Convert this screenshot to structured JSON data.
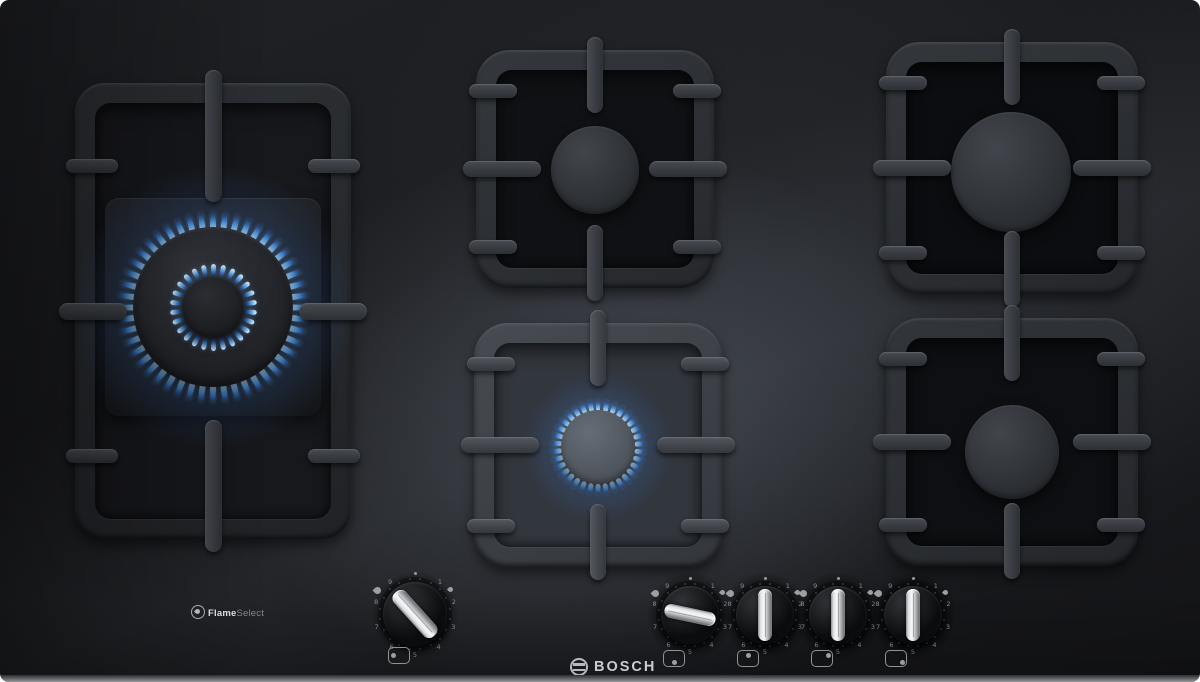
{
  "branding": {
    "maker_logo": "BOSCH",
    "feature_badge": {
      "bold": "Flame",
      "light": "Select"
    }
  },
  "dial": {
    "numbers": [
      "1",
      "2",
      "3",
      "4",
      "5",
      "6",
      "7",
      "8",
      "9"
    ]
  },
  "knobs": [
    {
      "id": "wok",
      "name": "left-wok-burner-knob",
      "angle_deg": -42,
      "position_icon": "left-center",
      "state": "on",
      "size": "large"
    },
    {
      "id": "front-center",
      "name": "front-center-burner-knob",
      "angle_deg": 102,
      "position_icon": "bottom-center",
      "state": "on",
      "size": "small"
    },
    {
      "id": "back-center",
      "name": "back-center-burner-knob",
      "angle_deg": 0,
      "position_icon": "top-center",
      "state": "off",
      "size": "small"
    },
    {
      "id": "back-right",
      "name": "back-right-burner-knob",
      "angle_deg": 0,
      "position_icon": "top-right",
      "state": "off",
      "size": "small"
    },
    {
      "id": "front-right",
      "name": "front-right-burner-knob",
      "angle_deg": 0,
      "position_icon": "bottom-right",
      "state": "off",
      "size": "small"
    }
  ],
  "burners": [
    {
      "id": "wok",
      "label": "left dual-ring wok burner",
      "lit": true,
      "rings": [
        {
          "radius": 86,
          "count": 48,
          "len": 19,
          "width": 6,
          "dir": "out"
        },
        {
          "radius": 37,
          "count": 26,
          "len": 13,
          "width": 5,
          "dir": "in"
        }
      ]
    },
    {
      "id": "back-center",
      "label": "back center burner",
      "lit": false
    },
    {
      "id": "front-center",
      "label": "front center burner",
      "lit": true,
      "rings": [
        {
          "radius": 42,
          "count": 34,
          "len": 11,
          "width": 4.5,
          "dir": "out"
        }
      ]
    },
    {
      "id": "back-right",
      "label": "back right large burner",
      "lit": false
    },
    {
      "id": "front-right",
      "label": "front right burner",
      "lit": false
    }
  ],
  "colors": {
    "flame_base": "#eaf6ff",
    "flame_mid": "#6fb1ec",
    "flame_deep": "#2a5fa8",
    "glass": "#1b1c1f",
    "grate": "#33373c",
    "chrome": "#e9ebed",
    "markings": "#96999c"
  }
}
